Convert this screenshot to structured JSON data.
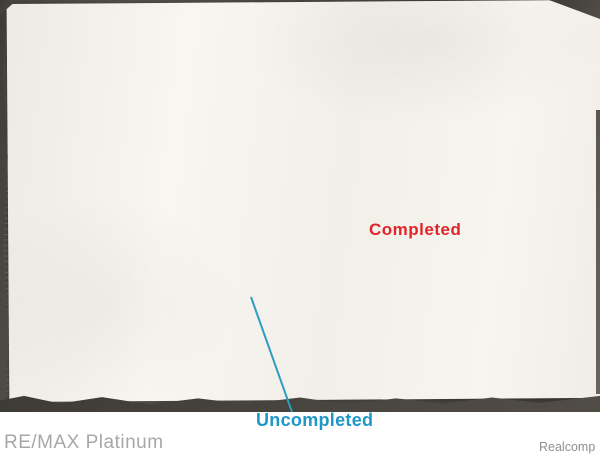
{
  "annotations": {
    "completed_label": "Completed",
    "uncompleted_label": "Uncompleted",
    "completed_color": "#e0242b",
    "uncompleted_color": "#1e96c8",
    "completed_hatch_color": "#c24b5f",
    "uncompleted_outline_color": "#3fa4c8"
  },
  "watermarks": {
    "brand": "RE/MAX Platinum",
    "source": "Realcomp"
  },
  "plat": {
    "labels": [
      {
        "t": "TORRY ROAD",
        "x": 300,
        "y": 27,
        "s": 7,
        "a": "middle",
        "ls": 3,
        "c": "#3a3a3a",
        "id": "torry-road-label"
      },
      {
        "t": "2175.08'",
        "x": 368,
        "y": 20,
        "s": 3.2,
        "c": "#666"
      },
      {
        "t": "PRELIMINARY PLAT FOR",
        "x": 272,
        "y": 87,
        "s": 4.6,
        "a": "middle",
        "ls": 1,
        "id": "title-line1"
      },
      {
        "t": "SILVER FOX ESTATES",
        "x": 272,
        "y": 99,
        "s": 11,
        "a": "middle",
        "ls": 2,
        "w": 500,
        "id": "title-line2"
      },
      {
        "t": "PART OF THE SOUTHEAST 1/4 OF SECTION 15,",
        "x": 272,
        "y": 107,
        "s": 4,
        "a": "middle",
        "id": "title-line3"
      },
      {
        "t": "T6N-R6E MUNDY TOWNSHIP, GENESEE COUNTY, MICHIGAN",
        "x": 272,
        "y": 113.5,
        "s": 4,
        "a": "middle",
        "id": "title-line4"
      },
      {
        "t": "EAST 1/4 CORNER",
        "x": 7,
        "y": 47,
        "s": 3.3
      },
      {
        "t": "OF SECTION 15, T6N-R6E",
        "x": 7,
        "y": 52,
        "s": 3.3
      },
      {
        "t": "MUNDY TOWNSHIP, GENESEE",
        "x": 7,
        "y": 57,
        "s": 3.3
      },
      {
        "t": "COUNTY, MICHIGAN",
        "x": 7,
        "y": 62,
        "s": 3.3
      },
      {
        "t": "SOUTHEAST CORNER",
        "x": 483,
        "y": 45,
        "s": 3.3
      },
      {
        "t": "OF SECTION 15, T6N-R6E",
        "x": 483,
        "y": 50,
        "s": 3.3
      },
      {
        "t": "MUNDY TOWNSHIP, GENESEE",
        "x": 483,
        "y": 55,
        "s": 3.3
      },
      {
        "t": "COUNTY, MICHIGAN",
        "x": 483,
        "y": 60,
        "s": 3.3
      },
      {
        "t": "LEGEND",
        "x": 36,
        "y": 57,
        "s": 4,
        "ls": 0.5,
        "id": "legend-title"
      },
      {
        "t": "GENERAL NOTES",
        "x": 5,
        "y": 140,
        "s": 3.6,
        "id": "general-notes-title"
      },
      {
        "t": "SITE LOCATION MAP",
        "x": 162,
        "y": 115,
        "s": 3.6,
        "a": "middle",
        "id": "site-location-map-label"
      },
      {
        "t": "OVERALL LEGAL DESCRIPTION",
        "x": 397,
        "y": 64,
        "s": 3.8,
        "w": 700,
        "id": "legal-desc1-title"
      },
      {
        "t": "LEGAL DESCRIPTION - (PHASE 1)",
        "x": 397,
        "y": 103,
        "s": 3.8,
        "w": 700,
        "id": "legal-desc2-title"
      },
      {
        "t": "ZONED R5A",
        "x": 84,
        "y": 133,
        "s": 3.6,
        "c": "#555"
      },
      {
        "t": "ZONED R5A",
        "x": 348,
        "y": 133,
        "s": 3.6,
        "c": "#555"
      },
      {
        "t": "ZONED R5A",
        "x": 541,
        "y": 147,
        "s": 3.6,
        "c": "#555"
      },
      {
        "t": "ZONED R5A",
        "x": 538,
        "y": 322,
        "s": 3.6,
        "c": "#555"
      },
      {
        "t": "ZONED R5A",
        "x": 278,
        "y": 387,
        "s": 3.6,
        "c": "#555"
      },
      {
        "t": "ZONED R5A",
        "x": 50,
        "y": 210,
        "s": 3.6,
        "c": "#555",
        "r": -90,
        "a": "middle"
      },
      {
        "t": "UNPLATTED",
        "x": 18,
        "y": 129,
        "s": 6.5,
        "r": -10,
        "c": "#a09a8e",
        "i": 1,
        "f": "serif",
        "id": "unplatted-handwriting"
      },
      {
        "t": "UNPLATTED",
        "x": 16,
        "y": 382,
        "s": 6.5,
        "r": -4,
        "c": "#a09a8e",
        "i": 1,
        "f": "serif",
        "id": "unplatted-handwriting"
      },
      {
        "t": "UNPLATTED",
        "x": 462,
        "y": 378,
        "s": 6.5,
        "r": -6,
        "c": "#a09a8e",
        "i": 1,
        "f": "serif",
        "id": "unplatted-handwriting"
      },
      {
        "t": "UNPLATTED",
        "x": 352,
        "y": 108,
        "s": 4,
        "r": 36,
        "ls": 3.5,
        "c": "#8a8a8a"
      },
      {
        "t": "UNPLATTED",
        "x": 506,
        "y": 96,
        "s": 4,
        "r": 72,
        "ls": 3.5,
        "c": "#8a8a8a"
      },
      {
        "t": "original",
        "x": 12,
        "y": 26,
        "s": 6,
        "r": -24,
        "c": "#938d80",
        "i": 1,
        "f": "serif",
        "id": "original-handwriting"
      },
      {
        "t": "DETENTION",
        "x": 104,
        "y": 278,
        "s": 3.8,
        "a": "middle",
        "id": "detention-pond-label"
      },
      {
        "t": "POND",
        "x": 104,
        "y": 284,
        "s": 3.8,
        "a": "middle"
      },
      {
        "t": "QUARELLA DRIVE",
        "x": 142,
        "y": 341,
        "s": 3.2,
        "a": "middle",
        "r": -2,
        "c": "#444",
        "id": "quarella-drive-label"
      },
      {
        "t": "SILVER FOX RUN",
        "x": 244,
        "y": 336,
        "s": 3.2,
        "a": "middle",
        "r": -2,
        "c": "#444",
        "id": "silver-fox-run-label"
      },
      {
        "t": "QUAIL RIDGE",
        "x": 470,
        "y": 333,
        "s": 3.2,
        "a": "middle",
        "r": -2,
        "c": "#444",
        "id": "quail-ridge-label"
      },
      {
        "t": "GRAND BLANC ROAD",
        "x": 539,
        "y": 272,
        "s": 6.5,
        "r": -90,
        "a": "middle",
        "ls": 1.5,
        "c": "#333",
        "id": "grand-blanc-road-label"
      },
      {
        "t": "FUTURE DEVELOPMENT",
        "x": 98,
        "y": 163,
        "s": 3,
        "r": -24,
        "a": "middle",
        "c": "#777"
      },
      {
        "t": "FUTURE DEVELOPMENT",
        "x": 395,
        "y": 221,
        "s": 3,
        "r": -30,
        "a": "middle",
        "c": "#777"
      },
      {
        "t": "FUTURE DEVELOPMENT",
        "x": 278,
        "y": 355,
        "s": 3,
        "r": -32,
        "a": "middle",
        "c": "#777"
      },
      {
        "t": "P.O.B.",
        "x": 543,
        "y": 159,
        "s": 3.6,
        "w": 700,
        "id": "pob-label"
      },
      {
        "t": "BENCHMARK",
        "x": 543,
        "y": 175,
        "s": 3,
        "id": "benchmark-label"
      },
      {
        "t": "NO. 1",
        "x": 543,
        "y": 179,
        "s": 2.8
      },
      {
        "t": "GRAPHIC SCALE",
        "x": 246,
        "y": 391,
        "s": 3.6,
        "a": "middle",
        "ls": 0.5,
        "id": "graphic-scale-label"
      },
      {
        "t": "SITE INFORMATION",
        "x": 337,
        "y": 378,
        "s": 3.3,
        "w": 700,
        "id": "site-information-label"
      },
      {
        "t": "1336.40'",
        "x": 50,
        "y": 250,
        "s": 3,
        "r": -90,
        "a": "middle",
        "c": "#666"
      },
      {
        "t": "774.38'",
        "x": 531,
        "y": 128,
        "s": 3,
        "r": -90,
        "a": "middle",
        "c": "#666"
      },
      {
        "t": "PRELIMINARY PLAT FOR:",
        "x": 563,
        "y": 155,
        "s": 3.6,
        "r": -90,
        "a": "middle",
        "id": "sideblock-line1"
      },
      {
        "t": "SILVER FOX ESTATES",
        "x": 572,
        "y": 155,
        "s": 6,
        "r": -90,
        "a": "middle",
        "w": 700,
        "ls": 0.5,
        "id": "sideblock-line2"
      },
      {
        "t": "PART OF THE SOUTHEAST 1/4 OF SECTION 15,",
        "x": 580,
        "y": 155,
        "s": 2.4,
        "r": -90,
        "a": "middle"
      },
      {
        "t": "T6N-R6E MUNDY TOWNSHIP, GENESEE COUNTY, MICHIGAN",
        "x": 584,
        "y": 155,
        "s": 2.4,
        "r": -90,
        "a": "middle"
      },
      {
        "t": "DEVELOPED BY:",
        "x": 563,
        "y": 239,
        "s": 3.2,
        "r": -90,
        "a": "middle",
        "id": "developed-by-label"
      },
      {
        "t": "JIM QUARELLA & GLEN J. MARSACK",
        "x": 569,
        "y": 239,
        "s": 3,
        "r": -90,
        "a": "middle"
      },
      {
        "t": "FLINT SURVEYING",
        "x": 578,
        "y": 302,
        "s": 7.5,
        "r": -90,
        "a": "middle",
        "w": 900,
        "ls": 0.5,
        "c": "#2a2a2a",
        "id": "surveyor-logo"
      },
      {
        "t": "DATE",
        "x": 561,
        "y": 352,
        "s": 2.6,
        "r": -90,
        "a": "middle"
      },
      {
        "t": "SCALE",
        "x": 561,
        "y": 371,
        "s": 2.6,
        "r": -90,
        "a": "middle"
      },
      {
        "t": "JOB NO.",
        "x": 561,
        "y": 389,
        "s": 2.6,
        "r": -90,
        "a": "middle"
      }
    ],
    "lots": [
      {
        "n": "88",
        "x": 74,
        "y": 184
      },
      {
        "n": "89",
        "x": 88,
        "y": 162
      },
      {
        "n": "90",
        "x": 107,
        "y": 162
      },
      {
        "n": "91",
        "x": 126,
        "y": 162
      },
      {
        "n": "92",
        "x": 145,
        "y": 162
      },
      {
        "n": "93",
        "x": 164,
        "y": 162
      },
      {
        "n": "94",
        "x": 183,
        "y": 162
      },
      {
        "n": "95",
        "x": 202,
        "y": 162
      },
      {
        "n": "96",
        "x": 221,
        "y": 162
      },
      {
        "n": "97",
        "x": 240,
        "y": 162
      },
      {
        "n": "98",
        "x": 259,
        "y": 162
      },
      {
        "n": "99",
        "x": 265,
        "y": 171
      },
      {
        "n": "100",
        "x": 276,
        "y": 162
      },
      {
        "n": "79",
        "x": 66,
        "y": 212
      },
      {
        "n": "78",
        "x": 66,
        "y": 230
      },
      {
        "n": "77",
        "x": 66,
        "y": 248
      },
      {
        "n": "76",
        "x": 66,
        "y": 266
      },
      {
        "n": "75",
        "x": 163,
        "y": 253
      },
      {
        "n": "74",
        "x": 118,
        "y": 258
      },
      {
        "n": "73",
        "x": 60,
        "y": 300
      },
      {
        "n": "72",
        "x": 58,
        "y": 322
      },
      {
        "n": "70",
        "x": 50,
        "y": 246
      },
      {
        "n": "122",
        "x": 210,
        "y": 203
      },
      {
        "n": "121",
        "x": 230,
        "y": 203
      },
      {
        "n": "120",
        "x": 250,
        "y": 203
      },
      {
        "n": "119",
        "x": 270,
        "y": 203
      },
      {
        "n": "118",
        "x": 289,
        "y": 203
      },
      {
        "n": "117",
        "x": 308,
        "y": 203
      },
      {
        "n": "116",
        "x": 327,
        "y": 203
      },
      {
        "n": "115",
        "x": 346,
        "y": 203
      },
      {
        "n": "114",
        "x": 365,
        "y": 203
      },
      {
        "n": "123",
        "x": 210,
        "y": 241
      },
      {
        "n": "124",
        "x": 230,
        "y": 241
      },
      {
        "n": "125",
        "x": 250,
        "y": 241
      },
      {
        "n": "126",
        "x": 270,
        "y": 241
      },
      {
        "n": "127",
        "x": 289,
        "y": 241
      },
      {
        "n": "128",
        "x": 308,
        "y": 241
      },
      {
        "n": "145",
        "x": 205,
        "y": 280
      },
      {
        "n": "144",
        "x": 224,
        "y": 280
      },
      {
        "n": "143",
        "x": 243,
        "y": 280
      },
      {
        "n": "142",
        "x": 262,
        "y": 280
      },
      {
        "n": "141",
        "x": 281,
        "y": 280
      },
      {
        "n": "146",
        "x": 205,
        "y": 312
      },
      {
        "n": "147",
        "x": 224,
        "y": 312
      },
      {
        "n": "148",
        "x": 243,
        "y": 312
      },
      {
        "n": "149",
        "x": 262,
        "y": 312
      },
      {
        "n": "150",
        "x": 281,
        "y": 312
      },
      {
        "n": "152",
        "x": 317,
        "y": 312
      },
      {
        "n": "153",
        "x": 336,
        "y": 312
      },
      {
        "n": "154",
        "x": 355,
        "y": 312
      },
      {
        "n": "20",
        "x": 488,
        "y": 245
      },
      {
        "n": "18",
        "x": 462,
        "y": 272
      },
      {
        "n": "29",
        "x": 478,
        "y": 309
      },
      {
        "n": "28",
        "x": 494,
        "y": 306
      },
      {
        "n": "35",
        "x": 465,
        "y": 355
      },
      {
        "n": "36",
        "x": 479,
        "y": 355
      },
      {
        "n": "37",
        "x": 493,
        "y": 355
      },
      {
        "n": "38",
        "x": 507,
        "y": 355
      },
      {
        "n": "55",
        "x": 167,
        "y": 356
      },
      {
        "n": "54",
        "x": 188,
        "y": 356
      },
      {
        "n": "53",
        "x": 209,
        "y": 356
      },
      {
        "n": "52",
        "x": 230,
        "y": 356
      },
      {
        "n": "51",
        "x": 251,
        "y": 356
      },
      {
        "n": "50",
        "x": 272,
        "y": 356
      },
      {
        "n": "49",
        "x": 292,
        "y": 356
      },
      {
        "n": "48",
        "x": 312,
        "y": 356
      },
      {
        "n": "47",
        "x": 332,
        "y": 356
      },
      {
        "n": "46",
        "x": 352,
        "y": 356
      },
      {
        "n": "45",
        "x": 372,
        "y": 356
      },
      {
        "n": "44",
        "x": 392,
        "y": 356
      },
      {
        "n": "43",
        "x": 412,
        "y": 356
      },
      {
        "n": "42",
        "x": 432,
        "y": 356
      },
      {
        "n": "64",
        "x": 78,
        "y": 357
      },
      {
        "n": "63",
        "x": 98,
        "y": 357
      },
      {
        "n": "62",
        "x": 118,
        "y": 357
      },
      {
        "n": "61",
        "x": 138,
        "y": 357
      },
      {
        "n": "60",
        "x": 157,
        "y": 357
      }
    ]
  }
}
